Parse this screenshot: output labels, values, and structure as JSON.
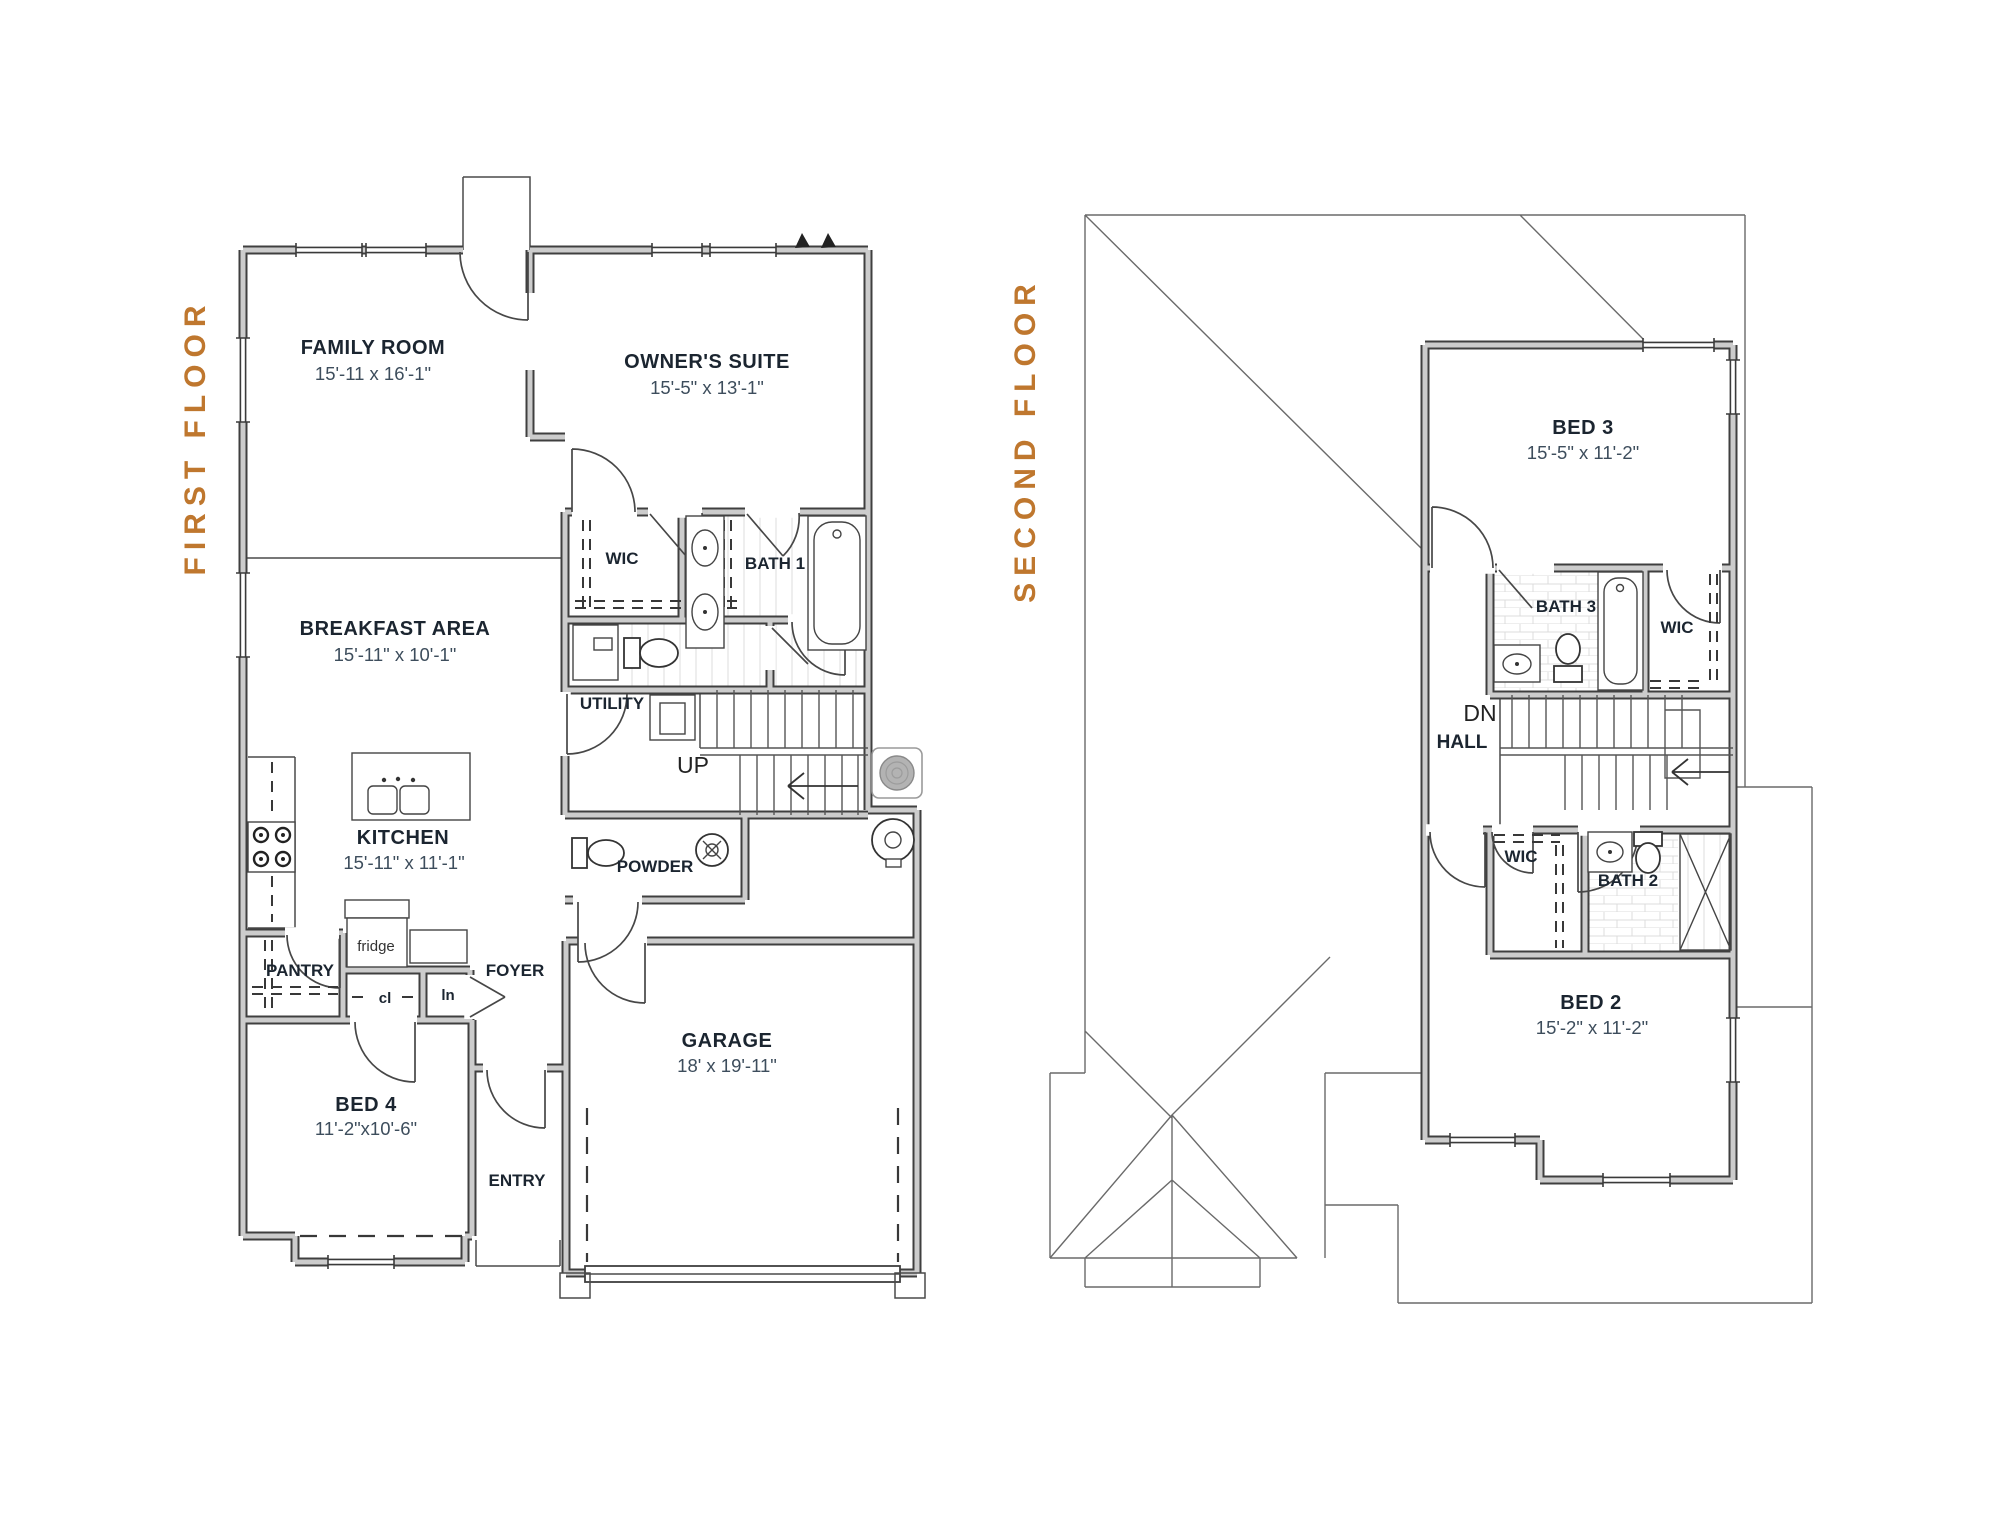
{
  "palette": {
    "accent": "#bf772e",
    "ink": "#1b2530",
    "dim": "#3d4d5c",
    "wall": "#3f3f3f"
  },
  "floors": {
    "first": {
      "title": "FIRST FLOOR",
      "rooms": {
        "family": {
          "name": "FAMILY ROOM",
          "dims": "15'-11 x 16'-1\""
        },
        "owners": {
          "name": "OWNER'S SUITE",
          "dims": "15'-5\" x 13'-1\""
        },
        "wic": {
          "name": "WIC"
        },
        "bath1": {
          "name": "BATH 1"
        },
        "breakfast": {
          "name": "BREAKFAST AREA",
          "dims": "15'-11\" x 10'-1\""
        },
        "utility": {
          "name": "UTILITY"
        },
        "up": {
          "name": "UP"
        },
        "kitchen": {
          "name": "KITCHEN",
          "dims": "15'-11\" x 11'-1\""
        },
        "powder": {
          "name": "POWDER"
        },
        "pantry": {
          "name": "PANTRY"
        },
        "fridge": {
          "name": "fridge"
        },
        "closet": {
          "name": "cl"
        },
        "linen": {
          "name": "ln"
        },
        "foyer": {
          "name": "FOYER"
        },
        "bed4": {
          "name": "BED 4",
          "dims": "11'-2\"x10'-6\""
        },
        "entry": {
          "name": "ENTRY"
        },
        "garage": {
          "name": "GARAGE",
          "dims": "18' x 19'-11\""
        }
      }
    },
    "second": {
      "title": "SECOND FLOOR",
      "rooms": {
        "bed3": {
          "name": "BED 3",
          "dims": "15'-5\" x 11'-2\""
        },
        "bath3": {
          "name": "BATH 3"
        },
        "wic_r": {
          "name": "WIC"
        },
        "dn": {
          "name": "DN"
        },
        "hall": {
          "name": "HALL"
        },
        "wic_l": {
          "name": "WIC"
        },
        "bath2": {
          "name": "BATH 2"
        },
        "bed2": {
          "name": "BED 2",
          "dims": "15'-2\" x 11'-2\""
        }
      }
    }
  }
}
